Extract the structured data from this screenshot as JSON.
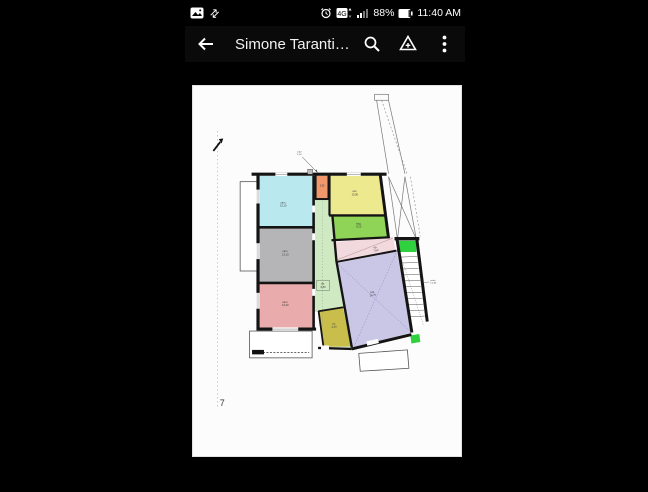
{
  "status_bar": {
    "time": "11:40 AM",
    "battery_percent": "88%",
    "network": "4G",
    "sync_glyph": "⇄"
  },
  "app_bar": {
    "title": "Simone Taranti…"
  },
  "plan": {
    "sheet_number": "7",
    "colors": {
      "wall": "#141414",
      "stair_green": "#2fd13f",
      "page": "#fcfcfc"
    },
    "rooms": [
      {
        "name": "room-cyan",
        "color": "#b9e9ee",
        "l1": "cam.",
        "l2": "15,10"
      },
      {
        "name": "room-orange",
        "color": "#f0986c",
        "l1": "3,50",
        "l2": ""
      },
      {
        "name": "room-yellow",
        "color": "#ece98e",
        "l1": "cuc.",
        "l2": "13,90"
      },
      {
        "name": "room-lime",
        "color": "#8fd456",
        "l1": "bag.",
        "l2": "8,20"
      },
      {
        "name": "room-gray",
        "color": "#b5b5b7",
        "l1": "cam.",
        "l2": "13,10"
      },
      {
        "name": "room-rose",
        "color": "#e9abab",
        "l1": "cam.",
        "l2": "12,40"
      },
      {
        "name": "corridor",
        "color": "#cfe9c2",
        "l1": "dis.",
        "l2": "9,80"
      },
      {
        "name": "room-pink",
        "color": "#f2d9de",
        "l1": "rip.",
        "l2": "7,60"
      },
      {
        "name": "room-purple",
        "color": "#c9c6e6",
        "l1": "sog.",
        "l2": "26,70"
      },
      {
        "name": "room-olive",
        "color": "#c9be4b",
        "l1": "wc",
        "l2": "4,30"
      }
    ],
    "notes": {
      "stairs_1": "scala",
      "stairs_2": "h 2,60",
      "detail_1": "2,00",
      "detail_2": "1,10"
    }
  }
}
